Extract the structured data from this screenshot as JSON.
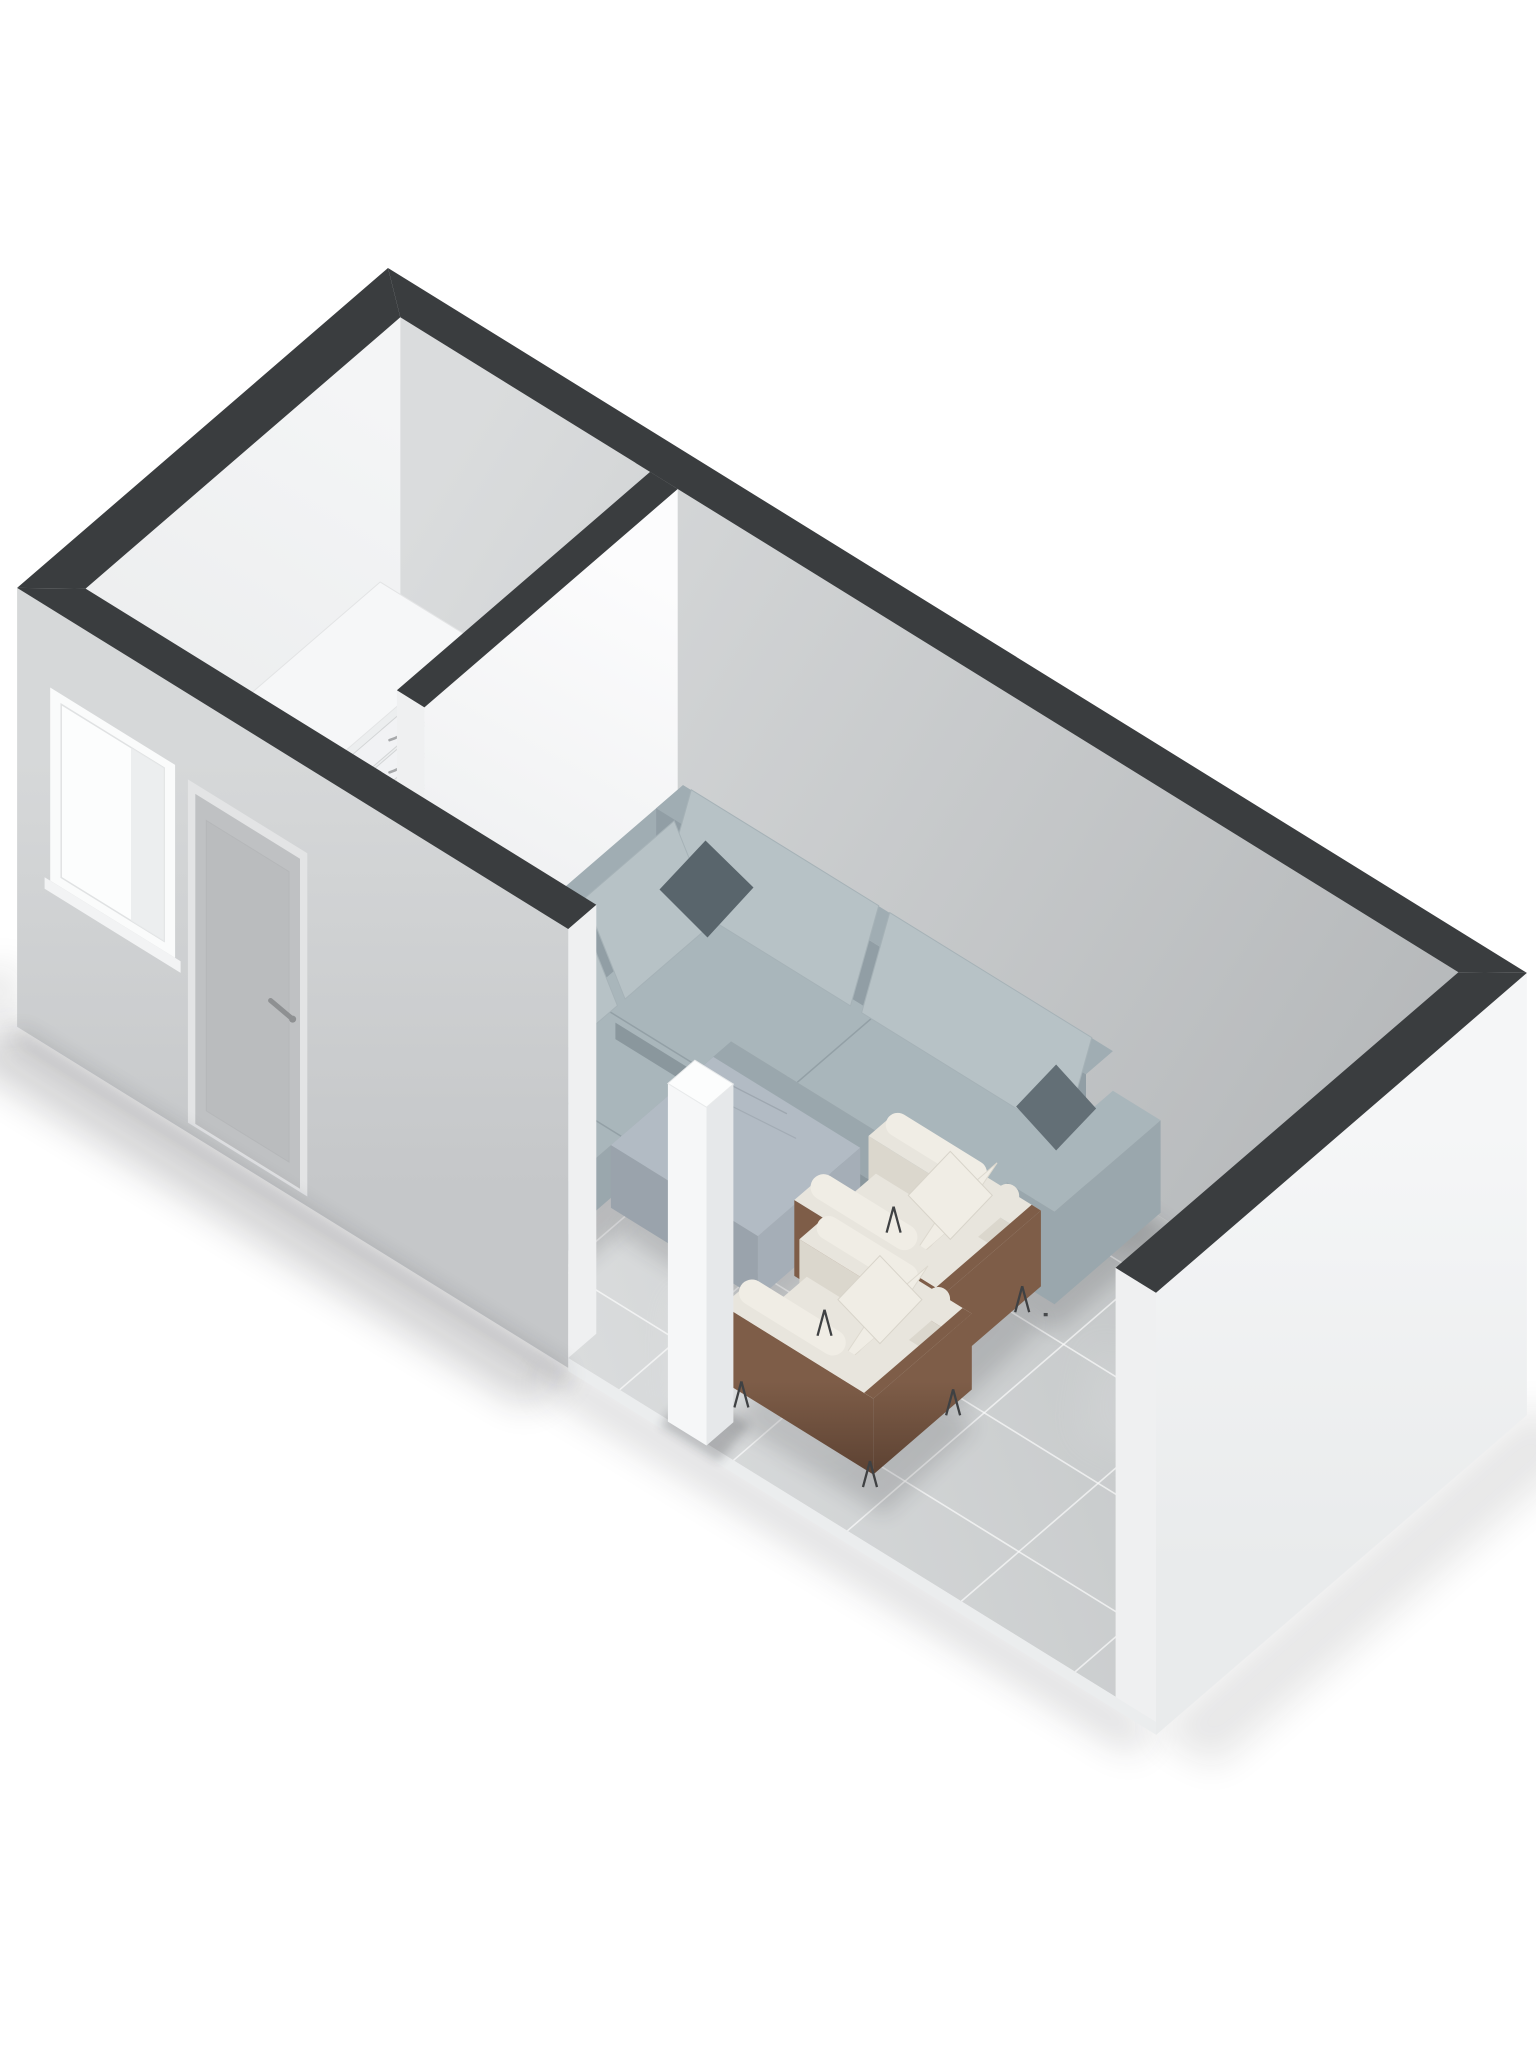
{
  "scene": {
    "type": "3d-floorplan-isometric-render",
    "view": "top-down-oblique",
    "background": "#ffffff",
    "rooms": [
      {
        "name": "small-room",
        "floor": "plain-light-gray",
        "openings": [
          "entry-door",
          "window",
          "interior-doorway"
        ]
      },
      {
        "name": "living-room",
        "floor": "glossy-light-gray-tiles",
        "openings": [
          "open-front-side"
        ]
      }
    ],
    "architecture": [
      {
        "name": "wall-caps",
        "color": "#3a3d3f"
      },
      {
        "name": "exterior-wall-left",
        "features": [
          "window",
          "door-with-handle"
        ]
      },
      {
        "name": "exterior-wall-right-end",
        "features": []
      },
      {
        "name": "partition-wall",
        "features": [
          "open-doorway-gap"
        ]
      },
      {
        "name": "structural-column",
        "color": "white"
      }
    ],
    "furniture": [
      {
        "name": "corner-sofa",
        "shape": "L",
        "fabric": "gray-blue",
        "throw_pillows": 2
      },
      {
        "name": "ottoman",
        "fabric": "gray-blue"
      },
      {
        "name": "armchair-far",
        "fabric": "cream",
        "frame": "brown-wood",
        "legs": "black-hairpin"
      },
      {
        "name": "armchair-near",
        "fabric": "cream",
        "frame": "brown-wood",
        "legs": "black-hairpin"
      },
      {
        "name": "chest-of-drawers",
        "color": "white",
        "drawers": 5,
        "handles": "curved-metal"
      },
      {
        "name": "storage-panel",
        "color": "beige"
      }
    ],
    "colors": {
      "background": "#ffffff",
      "wall_cap": "#3a3d3f",
      "wall_int_bright": "#f4f5f6",
      "wall_int_bright2": "#e7e9ea",
      "wall_int_shade1": "#dadcdd",
      "wall_int_shade2": "#b3b6b8",
      "partition_face1": "#fcfcfd",
      "partition_face2": "#e9ebec",
      "wall_end_cap": "#eff0f1",
      "sw_ext1": "#d6d8d9",
      "sw_ext2": "#c5c7c9",
      "se_ext1": "#f5f6f7",
      "se_ext2": "#e9ebec",
      "floor1": "#c7cacb",
      "floor2": "#dadcdd",
      "grout": "#ffffff",
      "small_floor": "#d5d6d2",
      "slab_edge": "#ebedee",
      "sofa_seat": "#a9b6bb",
      "sofa_front": "#9aa7ad",
      "sofa_back": "#919ea5",
      "sofa_back_top": "#a0adb3",
      "sofa_cushion": "#b7c2c6",
      "sofa_seam": "#93a0a6",
      "sofa_base": "#8a979d",
      "pillow_dark": "#59656c",
      "pillow_dark2": "#636f76",
      "ottoman_top": "#b2bbc4",
      "ottoman_side1": "#a5aeb7",
      "ottoman_side2": "#9aa3ac",
      "chair_fabric": "#e8e5dd",
      "chair_fabric_bright": "#f0ede5",
      "chair_fabric_dim": "#dbd7cd",
      "wood1": "#7e5d48",
      "wood2": "#5f4434",
      "leg_metal": "#3f4143",
      "dresser_top": "#f6f7f8",
      "dresser_front": "#eceeef",
      "dresser_side": "#e2e4e5",
      "dresser_line": "#d3d5d6",
      "handle": "#a6a8aa",
      "box_top": "#dbd8cb",
      "box_side": "#cfccbe",
      "box_side2": "#c4c1b3",
      "door_frame": "#e3e4e5",
      "door_panel": "#bfc1c3",
      "door_panel2": "#b4b6b8",
      "door_handle": "#8e9092",
      "window_frame": "#fafbfb",
      "window_inner": "#fcfdfd",
      "window_shade": "#e9ebec",
      "pillar_top": "#fcfdfd",
      "pillar_left": "#f6f7f8",
      "pillar_right": "#e6e8ea",
      "shadow": "#1c1e20"
    }
  }
}
